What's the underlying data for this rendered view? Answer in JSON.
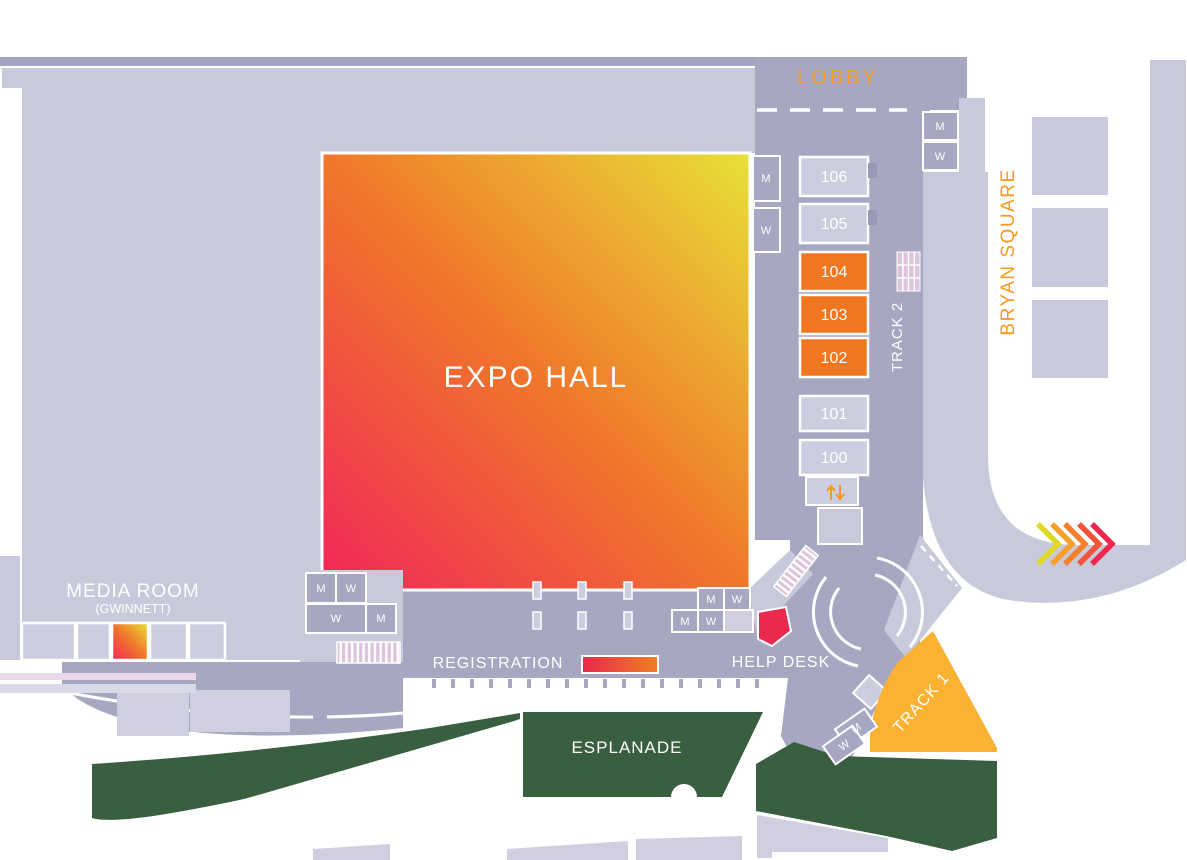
{
  "floorplan": {
    "labels": {
      "lobby": "LOBBY",
      "expo_hall": "EXPO HALL",
      "bryan_square": "BRYAN SQUARE",
      "track_2": "TRACK 2",
      "track_1": "TRACK 1",
      "media_room": "MEDIA ROOM",
      "media_room_note": "(GWINNETT)",
      "registration": "REGISTRATION",
      "help_desk": "HELP DESK",
      "esplanade": "ESPLANADE"
    },
    "restroom": {
      "men": "M",
      "women": "W"
    },
    "rooms": [
      {
        "number": "106",
        "highlighted": false,
        "fill": "#cdcde0"
      },
      {
        "number": "105",
        "highlighted": false,
        "fill": "#cdcde0"
      },
      {
        "number": "104",
        "highlighted": true,
        "fill": "#f0761f"
      },
      {
        "number": "103",
        "highlighted": true,
        "fill": "#f0761f"
      },
      {
        "number": "102",
        "highlighted": true,
        "fill": "#f0761f"
      },
      {
        "number": "101",
        "highlighted": false,
        "fill": "#cdcde0"
      },
      {
        "number": "100",
        "highlighted": false,
        "fill": "#cdcde0"
      }
    ],
    "colors": {
      "building_light": "#c9c9dc",
      "building_lighter": "#cfcfe0",
      "walkway": "#a7a7c2",
      "top_strip": "#a4a4c1",
      "room_default": "#cdcde0",
      "room_highlight": "#f0761f",
      "track1": "#fbb232",
      "esplanade_green": "#3a5e40",
      "help_desk_red": "#e92a4e",
      "label_orange": "#f5a02c",
      "bryan_orange": "#f49b22",
      "elevator_orange": "#f5991f",
      "hatch_pink": "#dcc3de",
      "expo_gradient": [
        "#f1255b",
        "#f0772a",
        "#e7e138"
      ],
      "registration_bar": [
        "#e9274c",
        "#f07f24"
      ],
      "chevrons": [
        "#ded926",
        "#f69f2c",
        "#f4802e",
        "#f1543a",
        "#ee2950"
      ]
    }
  }
}
